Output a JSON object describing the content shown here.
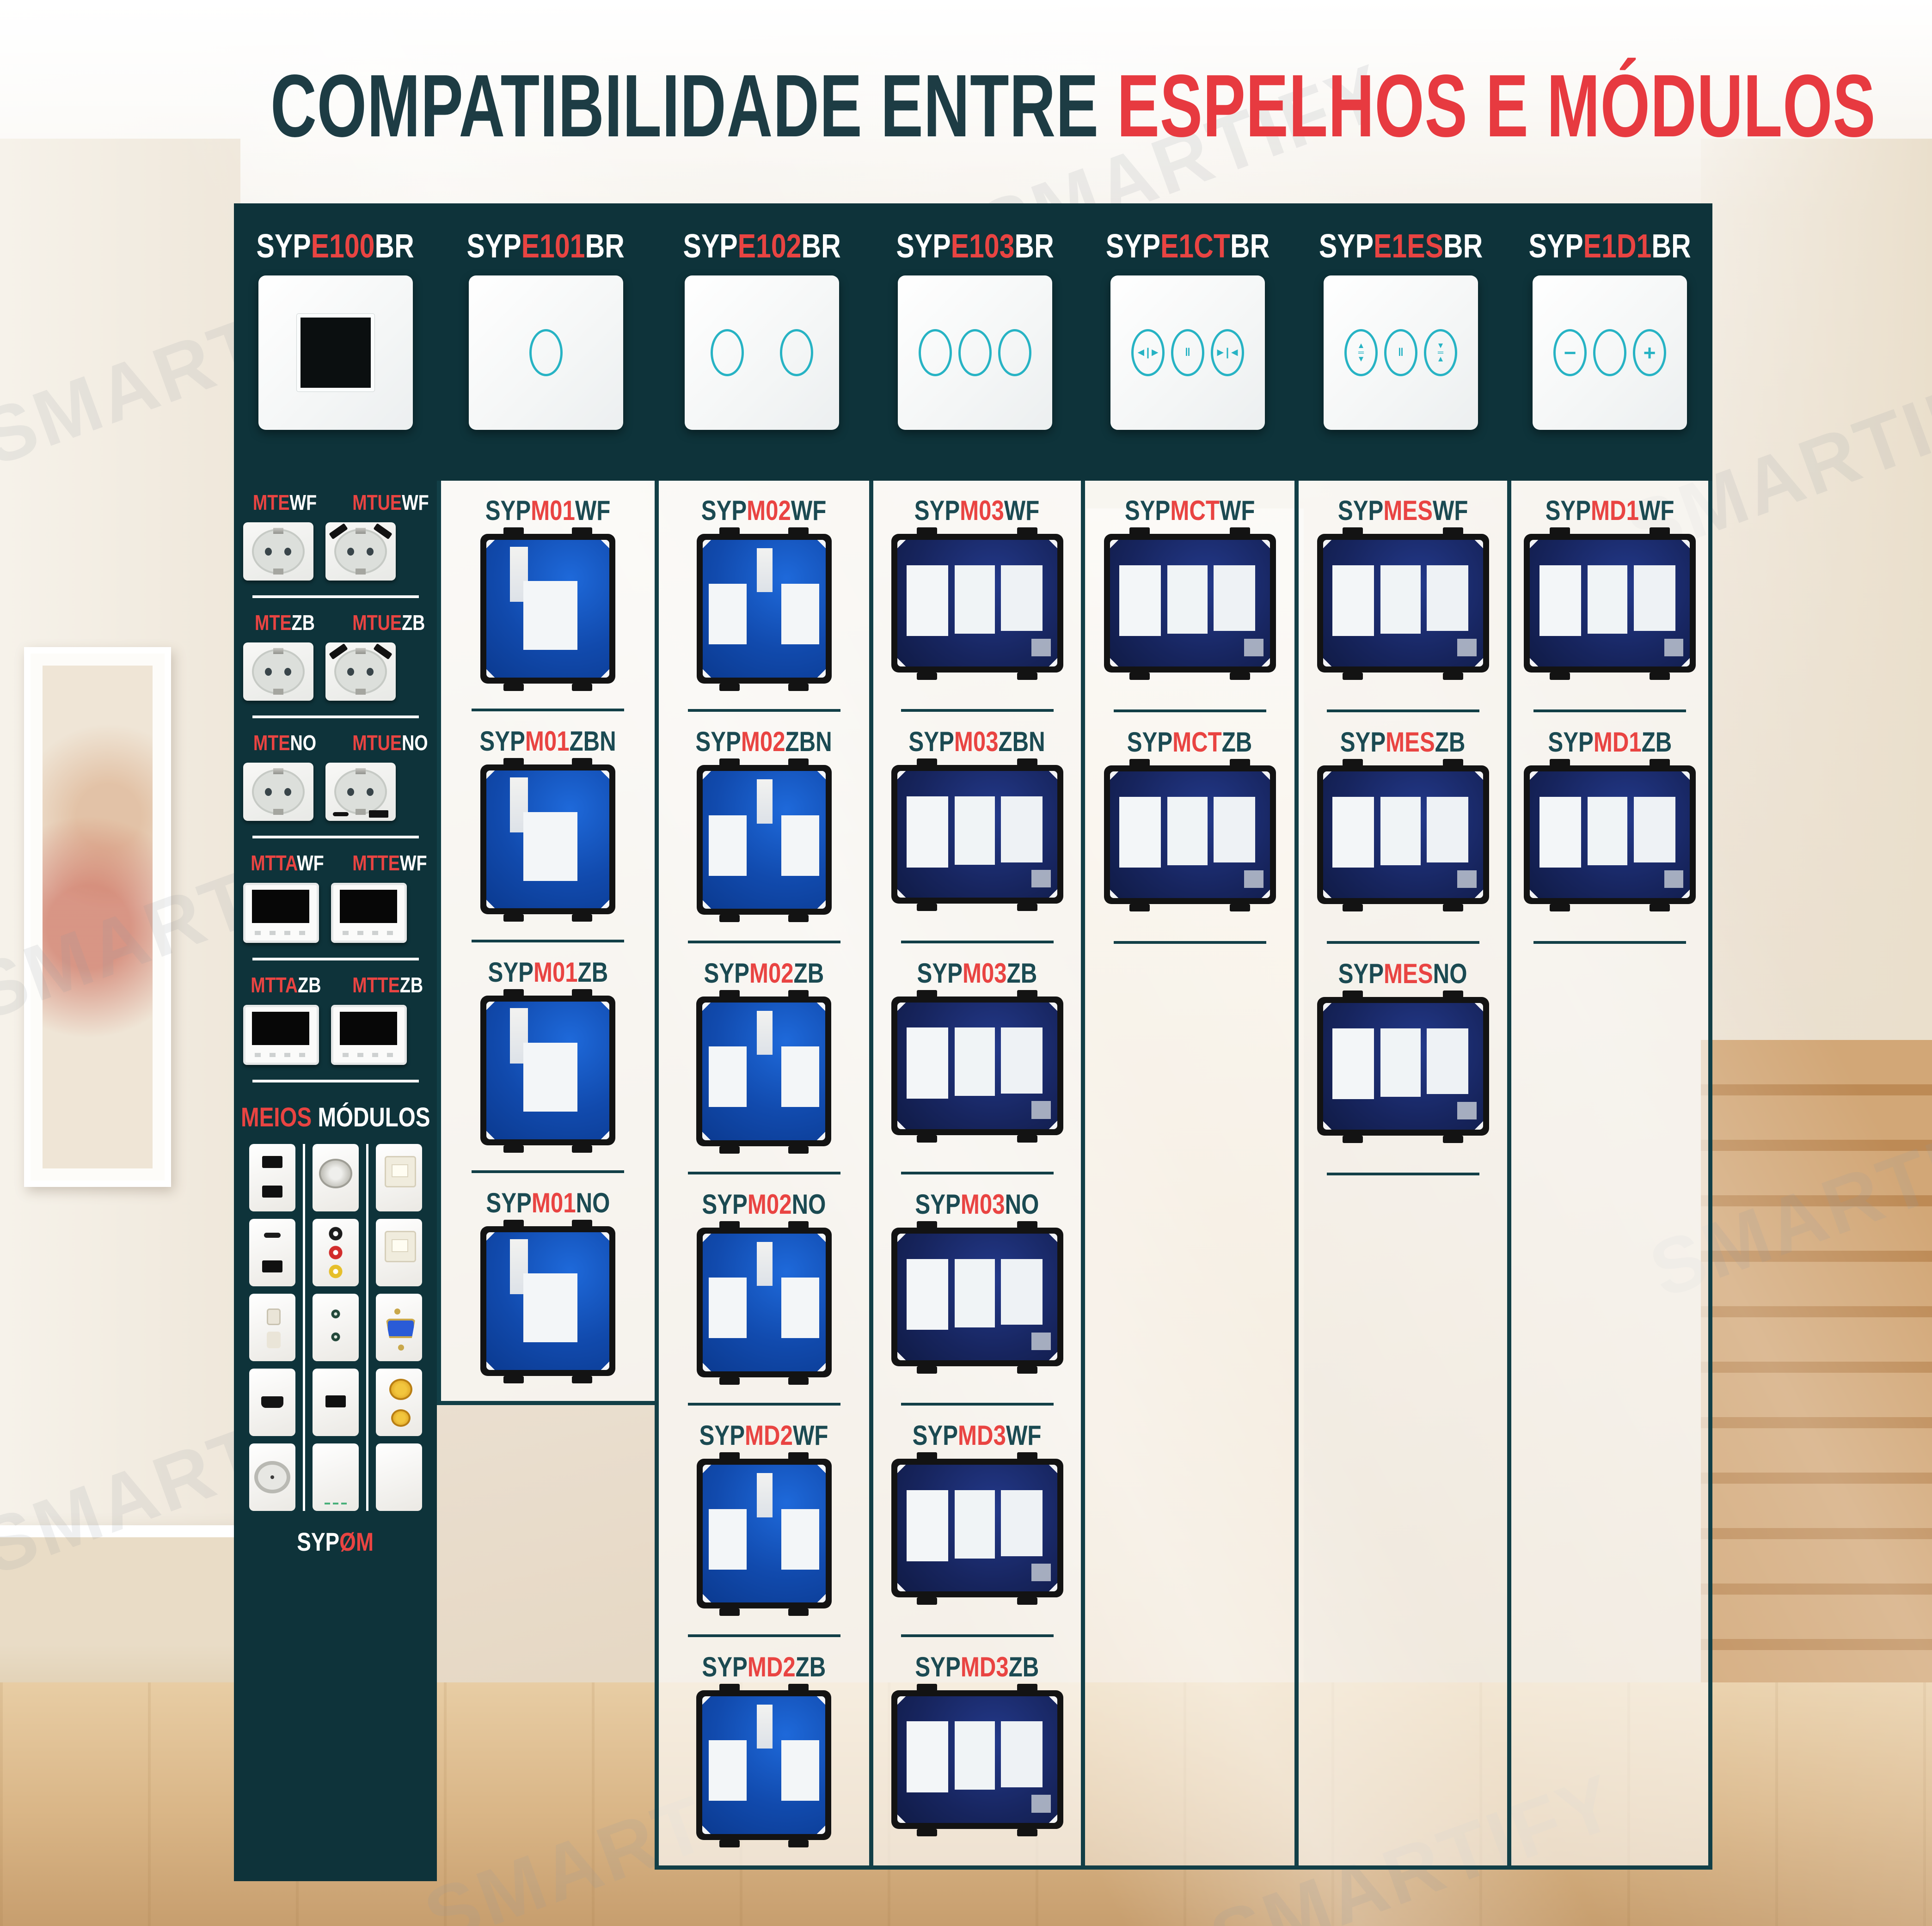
{
  "title": {
    "part1": "COMPATIBILIDADE ENTRE ",
    "part2": "ESPELHOS E MÓDULOS"
  },
  "watermark": {
    "text": "SMARTIFY"
  },
  "header": {
    "plates": [
      {
        "pre": "SYP",
        "mid": "E100",
        "suf": "BR"
      },
      {
        "pre": "SYP",
        "mid": "E101",
        "suf": "BR"
      },
      {
        "pre": "SYP",
        "mid": "E102",
        "suf": "BR"
      },
      {
        "pre": "SYP",
        "mid": "E103",
        "suf": "BR"
      },
      {
        "pre": "SYP",
        "mid": "E1CT",
        "suf": "BR",
        "glyphs": [
          "◄|►",
          "‖",
          "►|◄"
        ]
      },
      {
        "pre": "SYP",
        "mid": "E1ES",
        "suf": "BR",
        "glyphs": [
          "▲\n═\n▼",
          "‖",
          "▼\n═\n▲"
        ]
      },
      {
        "pre": "SYP",
        "mid": "E1D1",
        "suf": "BR",
        "glyphs": [
          "−",
          "",
          "+"
        ]
      }
    ]
  },
  "sidebar": {
    "rows": [
      {
        "labels": [
          {
            "pre": "MTE",
            "suf": "WF"
          },
          {
            "pre": "MTUE",
            "suf": "WF"
          }
        ]
      },
      {
        "labels": [
          {
            "pre": "MTE",
            "suf": "ZB"
          },
          {
            "pre": "MTUE",
            "suf": "ZB"
          }
        ]
      },
      {
        "labels": [
          {
            "pre": "MTE",
            "suf": "NO"
          },
          {
            "pre": "MTUE",
            "suf": "NO"
          }
        ]
      },
      {
        "labels": [
          {
            "pre": "MTTA",
            "suf": "WF"
          },
          {
            "pre": "MTTE",
            "suf": "WF"
          }
        ]
      },
      {
        "labels": [
          {
            "pre": "MTTA",
            "suf": "ZB"
          },
          {
            "pre": "MTTE",
            "suf": "ZB"
          }
        ]
      }
    ],
    "half_modules": {
      "title": {
        "pre": "MEIOS",
        "suf": " MÓDULOS"
      },
      "cols": [
        {
          "tiles": [
            "usb-double",
            "usb-ca",
            "socket-2pin",
            "mini-usb",
            "tv-coax"
          ]
        },
        {
          "tiles": [
            "speaker",
            "rca-triple",
            "jack-double",
            "usb-single",
            "blank-marks"
          ]
        },
        {
          "tiles": [
            "rj45",
            "rj45",
            "vga",
            "banana",
            "blank"
          ]
        }
      ],
      "footer": {
        "pre": "SYP",
        "suf": "ØM"
      }
    }
  },
  "columns": [
    {
      "modules": [
        {
          "pre": "SYP",
          "mid": "M01",
          "suf": "WF"
        },
        {
          "pre": "SYP",
          "mid": "M01",
          "suf": "ZBN"
        },
        {
          "pre": "SYP",
          "mid": "M01",
          "suf": "ZB"
        },
        {
          "pre": "SYP",
          "mid": "M01",
          "suf": "NO"
        }
      ]
    },
    {
      "modules": [
        {
          "pre": "SYP",
          "mid": "M02",
          "suf": "WF"
        },
        {
          "pre": "SYP",
          "mid": "M02",
          "suf": "ZBN"
        },
        {
          "pre": "SYP",
          "mid": "M02",
          "suf": "ZB"
        },
        {
          "pre": "SYP",
          "mid": "M02",
          "suf": "NO"
        },
        {
          "pre": "SYP",
          "mid": "MD2",
          "suf": "WF"
        },
        {
          "pre": "SYP",
          "mid": "MD2",
          "suf": "ZB"
        }
      ]
    },
    {
      "modules": [
        {
          "pre": "SYP",
          "mid": "M03",
          "suf": "WF"
        },
        {
          "pre": "SYP",
          "mid": "M03",
          "suf": "ZBN"
        },
        {
          "pre": "SYP",
          "mid": "M03",
          "suf": "ZB"
        },
        {
          "pre": "SYP",
          "mid": "M03",
          "suf": "NO"
        },
        {
          "pre": "SYP",
          "mid": "MD3",
          "suf": "WF"
        },
        {
          "pre": "SYP",
          "mid": "MD3",
          "suf": "ZB"
        }
      ]
    },
    {
      "modules": [
        {
          "pre": "SYP",
          "mid": "MCT",
          "suf": "WF"
        },
        {
          "pre": "SYP",
          "mid": "MCT",
          "suf": "ZB"
        }
      ]
    },
    {
      "modules": [
        {
          "pre": "SYP",
          "mid": "MES",
          "suf": "WF"
        },
        {
          "pre": "SYP",
          "mid": "MES",
          "suf": "ZB"
        },
        {
          "pre": "SYP",
          "mid": "MES",
          "suf": "NO"
        }
      ]
    },
    {
      "modules": [
        {
          "pre": "SYP",
          "mid": "MD1",
          "suf": "WF"
        },
        {
          "pre": "SYP",
          "mid": "MD1",
          "suf": "ZB"
        }
      ]
    }
  ],
  "colors": {
    "teal_dark": "#0e333a",
    "red": "#e94442",
    "code_teal": "#1b4a52",
    "icon_teal": "#27b3c4"
  }
}
